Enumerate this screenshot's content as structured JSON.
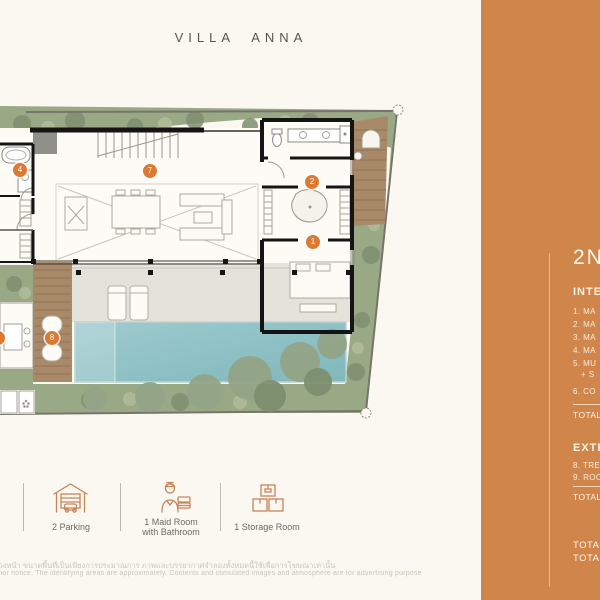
{
  "title": "VILLA ANNA",
  "colors": {
    "background": "#FAF8F0",
    "sidebar_orange": "#D0854A",
    "badge_orange": "#DC7A33",
    "pool_teal": "#8CC1C4",
    "greenery_green": "#9AA985",
    "deck_wood": "#A88968",
    "wall_black": "#141414"
  },
  "sidebar": {
    "heading": "2N",
    "interior": {
      "label": "INTE",
      "items": [
        "1.  MA",
        "2.  MA",
        "3.  MA",
        "4.  MA",
        "5.  MU",
        "+ S",
        "6.  CO"
      ],
      "total_label": "TOTAL"
    },
    "exterior": {
      "label": "EXTE",
      "items": [
        "8.  TRE",
        "9.  ROO"
      ],
      "total_label": "TOTAL"
    },
    "grand_totals": [
      "TOTAL",
      "TOTAL"
    ]
  },
  "plan": {
    "badges": [
      {
        "num": "7"
      },
      {
        "num": "4"
      },
      {
        "num": "2"
      },
      {
        "num": "1"
      },
      {
        "num": "8"
      },
      {
        "num": "3"
      }
    ]
  },
  "legend": {
    "items": [
      {
        "icon": "garage-icon",
        "label": "2 Parking"
      },
      {
        "icon": "maid-icon",
        "label": "1 Maid Room",
        "label2": "with Bathroom"
      },
      {
        "icon": "storage-icon",
        "label": "1 Storage Room"
      }
    ]
  },
  "disclaimer": {
    "line_th": "ล่วงหน้า ขนาดพื้นที่เป็นเพียงการประมาณการ ภาพและบรรยากาศจำลองทั้งหมดนี้ใช้เพื่อการโฆษณาเท่านั้น",
    "line_en": "prior notice. The identifying areas are approximately. Contents and stimulated images and atmosphere are for advertising purpose only."
  }
}
